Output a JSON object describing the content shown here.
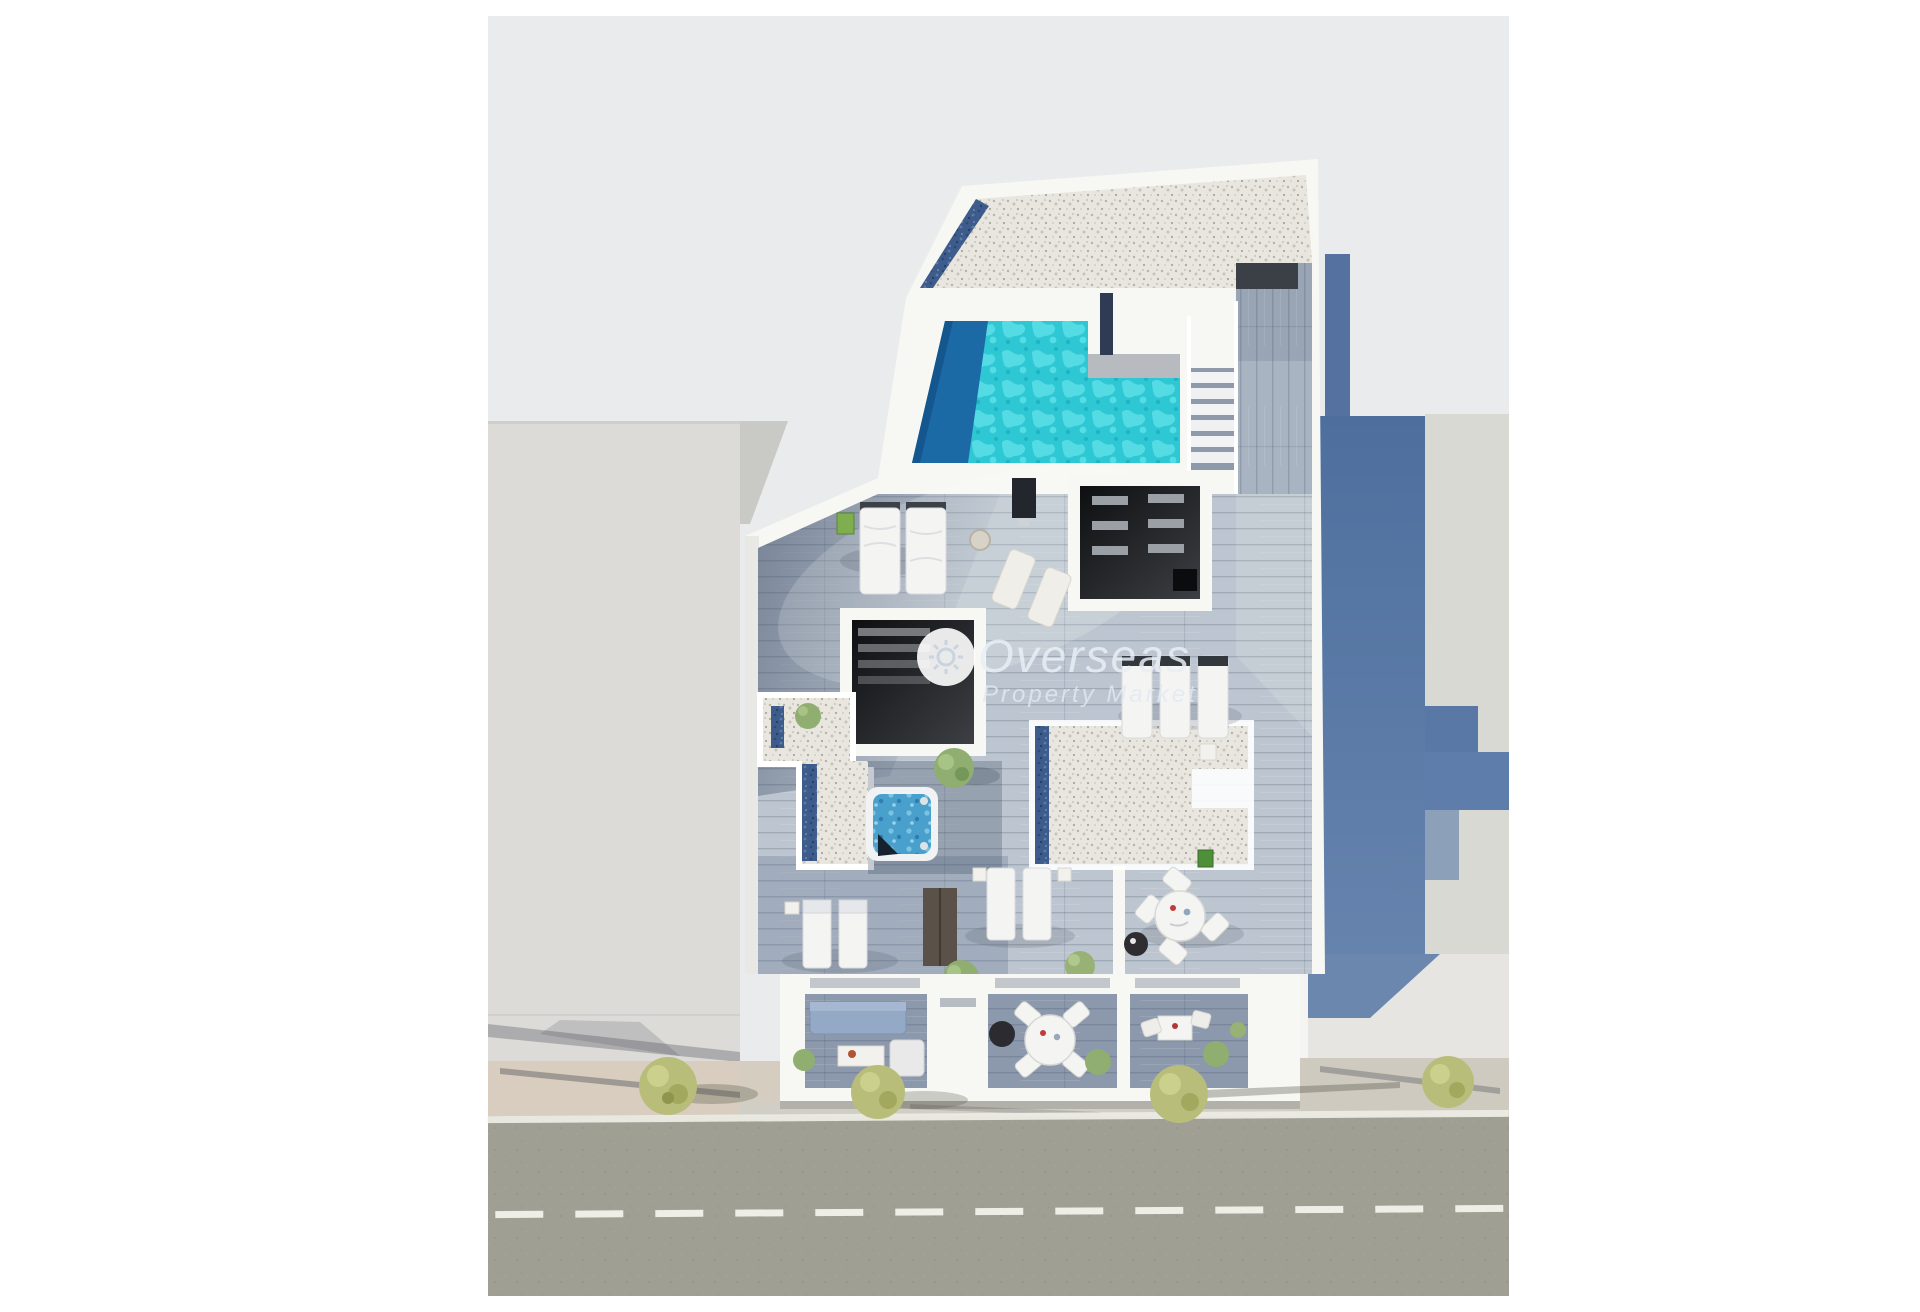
{
  "watermark": {
    "brand": "Overseas",
    "tagline": "Property Market",
    "icon": "sun-icon"
  },
  "scene": {
    "type": "3d-floorplan-render",
    "view": "top-down",
    "subject": "penthouse roof level with rooftop pool and street below",
    "elements": [
      "gravel-roof-terrace",
      "rooftop-pool",
      "pool-stairs",
      "wood-deck",
      "skylight-room",
      "tv-room",
      "jacuzzi",
      "gravel-patio-left",
      "gravel-patio-right",
      "sun-loungers",
      "double-beds",
      "outdoor-dining-set",
      "balcony-sofa",
      "balcony-dining-table",
      "balcony-bistro-table",
      "street-trees",
      "sidewalk",
      "road-with-lane-markings",
      "neighbor-building-left",
      "neighbor-building-right"
    ]
  },
  "colors": {
    "page_bg": "#ffffff",
    "backdrop": "#eaebec",
    "neighbor_left": "#dcdbd8",
    "neighbor_right": "#d9d9d4",
    "building_white": "#f7f7f4",
    "wall_blue": "#5576a4",
    "gravel": "#e8e6df",
    "gravel_blue_trim": "#3d5c8c",
    "deck_light": "#bdc6d0",
    "deck_medium": "#9fabbb",
    "deck_balcony": "#8c99ac",
    "pool_water": "#2ec7d4",
    "pool_deep": "#1b6aa6",
    "jacuzzi_water": "#4aa0cd",
    "room_dark": "#17181b",
    "road": "#9f9f94",
    "sidewalk": "#d6ccbd",
    "tree_olive": "#b9bd7a",
    "tree_green": "#8fae6f",
    "furniture_white": "#f4f4f2",
    "watermark_text": "#e9eff6"
  }
}
